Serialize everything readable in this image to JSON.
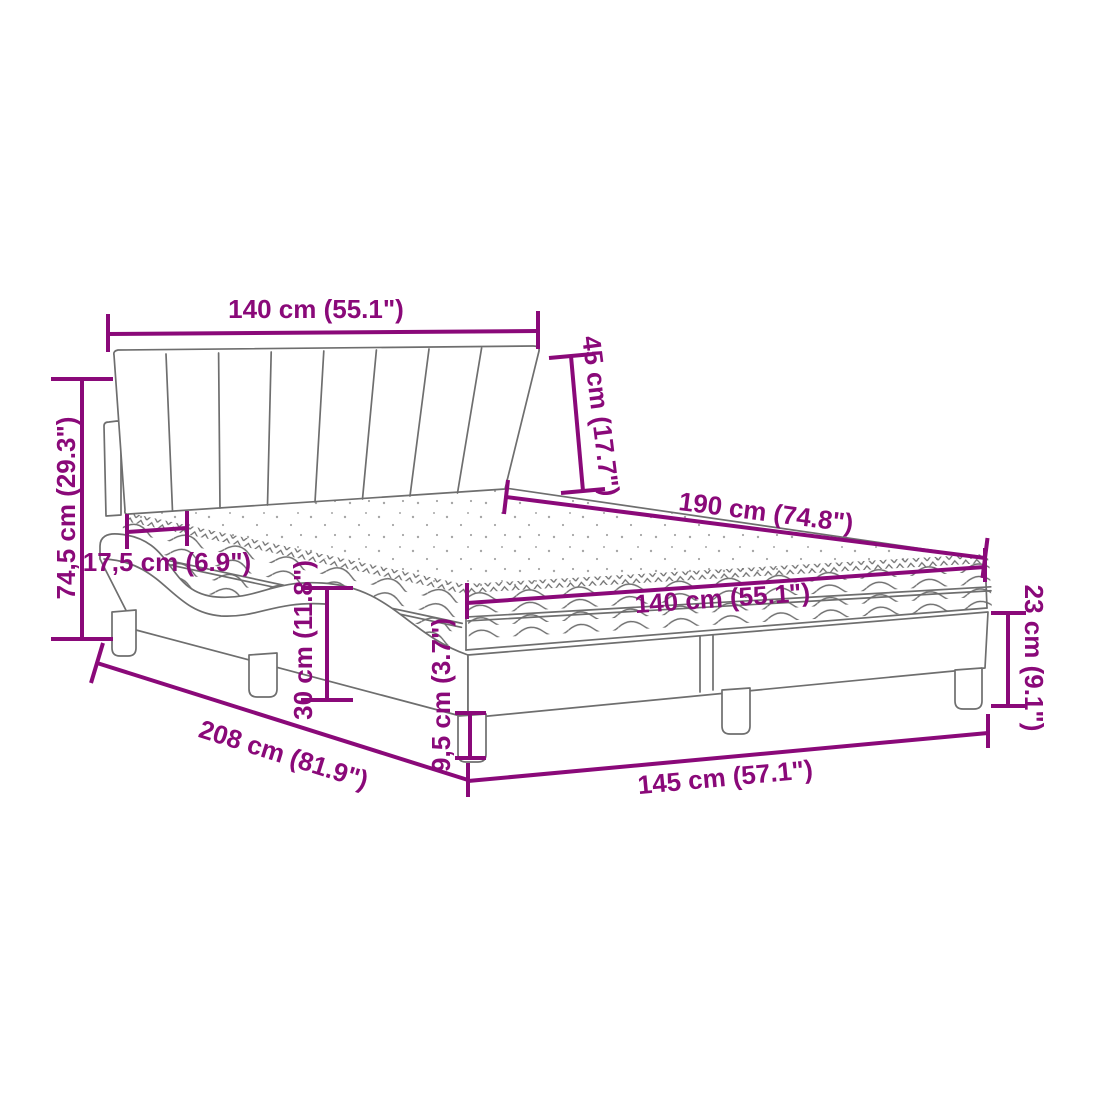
{
  "diagram": {
    "type": "product-dimension-diagram",
    "subject": "bed-with-mattress",
    "background_color": "#FFFFFF",
    "accent_color": "#8A0979",
    "artwork_line_color": "#6E6E6E",
    "measurements": [
      {
        "id": "headboard-width",
        "label": "140 cm (55.1\")"
      },
      {
        "id": "headboard-height",
        "label": "45 cm (17.7\")"
      },
      {
        "id": "mattress-length",
        "label": "190 cm (74.8\")"
      },
      {
        "id": "mattress-width",
        "label": "140 cm (55.1\")"
      },
      {
        "id": "base-corner-height",
        "label": "23 cm (9.1\")"
      },
      {
        "id": "base-front-width",
        "label": "145 cm (57.1\")"
      },
      {
        "id": "leg-height",
        "label": "9,5 cm (3.7\")"
      },
      {
        "id": "frame-side-height",
        "label": "30 cm (11.8\")"
      },
      {
        "id": "base-length",
        "label": "208 cm (81.9\")"
      },
      {
        "id": "mattress-inset",
        "label": "17,5 cm (6.9\")"
      },
      {
        "id": "total-height",
        "label": "74,5 cm (29.3\")"
      }
    ]
  }
}
